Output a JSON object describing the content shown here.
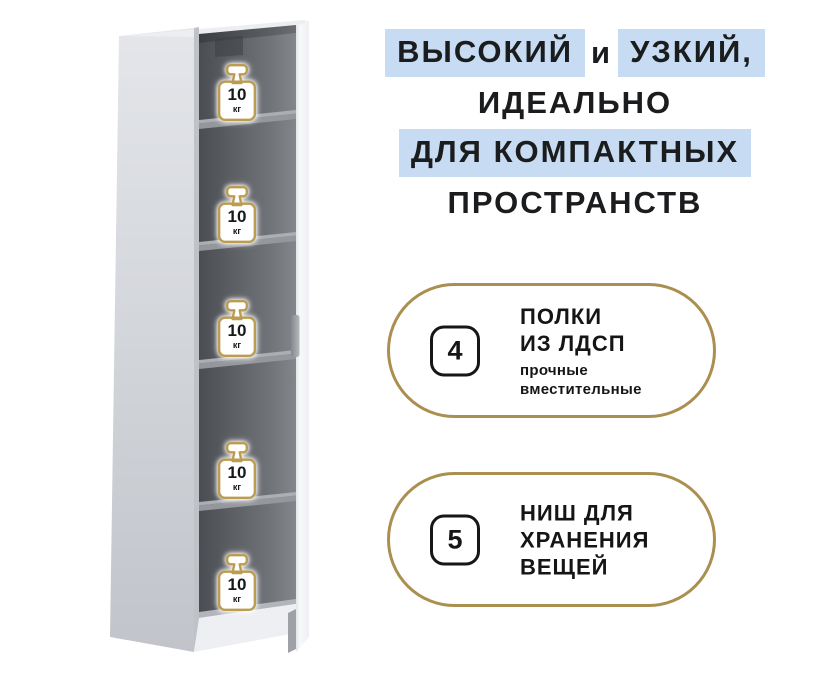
{
  "headline": {
    "line1_part1": "ВЫСОКИЙ",
    "line1_part2": "и",
    "line1_part3": "УЗКИЙ,",
    "line2": "ИДЕАЛЬНО",
    "line3": "ДЛЯ КОМПАКТНЫХ",
    "line4": "ПРОСТРАНСТВ",
    "highlight_color": "#c7dcf2",
    "text_color": "#1b1c1e"
  },
  "cabinet": {
    "description": "tall narrow white cabinet with open door and five niches",
    "shelves": [
      {
        "capacity": "10",
        "unit": "кг"
      },
      {
        "capacity": "10",
        "unit": "кг"
      },
      {
        "capacity": "10",
        "unit": "кг"
      },
      {
        "capacity": "10",
        "unit": "кг"
      },
      {
        "capacity": "10",
        "unit": "кг"
      }
    ],
    "colors": {
      "side_panel": "#cdd0d5",
      "interior_dark": "#4a4d52",
      "interior_light": "#83868b",
      "shelf_top": "#abaeb3",
      "shelf_edge": "#94979c",
      "door": "#f6f8fa",
      "weight_border_gold": "#bb9c51"
    }
  },
  "features": [
    {
      "count": "4",
      "title_line1": "ПОЛКИ",
      "title_line2": "ИЗ ЛДСП",
      "subtitle_line1": "прочные",
      "subtitle_line2": "вместительные"
    },
    {
      "count": "5",
      "title_line1": "НИШ ДЛЯ",
      "title_line2": "ХРАНЕНИЯ",
      "title_line3": "ВЕЩЕЙ"
    }
  ],
  "accent": {
    "pill_border_gold": "#ab8f50",
    "count_box_border": "#161616"
  }
}
